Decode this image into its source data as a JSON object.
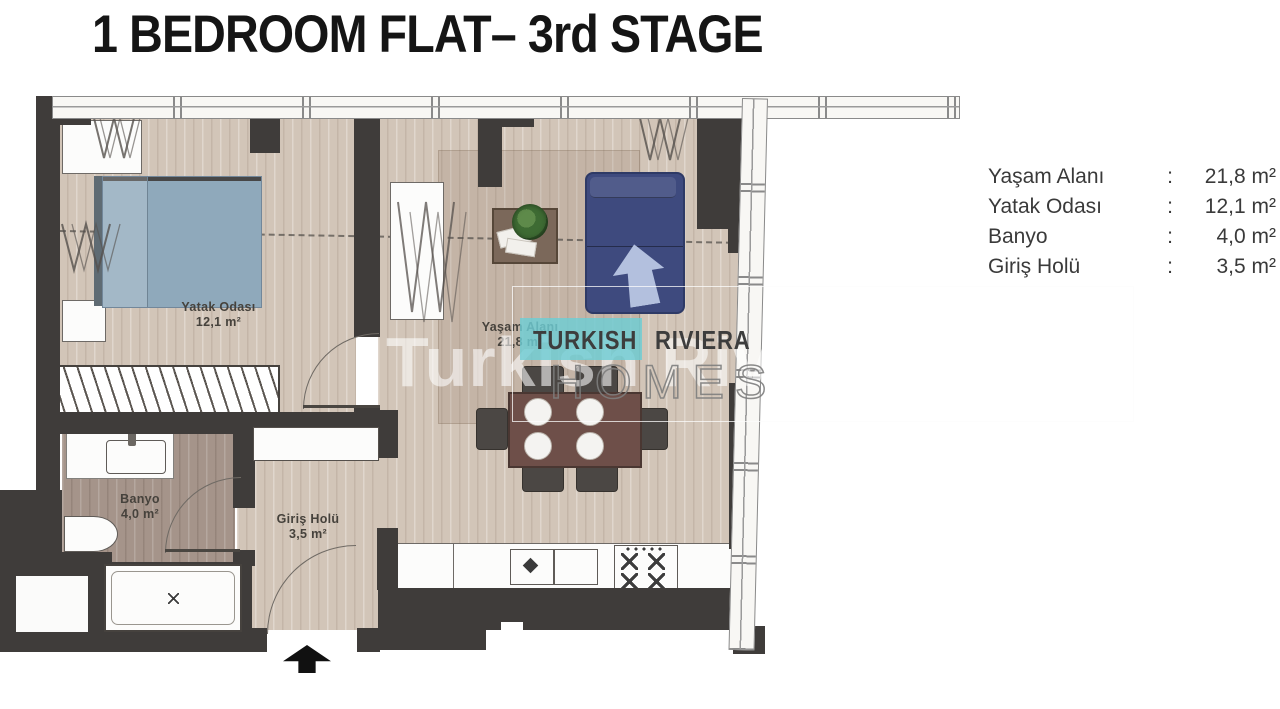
{
  "title": "1 BEDROOM FLAT– 3rd STAGE",
  "legend": {
    "rows": [
      {
        "label": "Yaşam Alanı",
        "separator": ":",
        "value": "21,8 m²"
      },
      {
        "label": "Yatak Odası",
        "separator": ":",
        "value": "12,1 m²"
      },
      {
        "label": "Banyo",
        "separator": ":",
        "value": "4,0 m²"
      },
      {
        "label": "Giriş Holü",
        "separator": ":",
        "value": "3,5 m²"
      }
    ]
  },
  "plan": {
    "rooms": {
      "bedroom": {
        "name": "Yatak Odası",
        "area": "12,1 m²"
      },
      "living": {
        "name": "Yaşam Alanı",
        "area": "21,8 m²"
      },
      "bathroom": {
        "name": "Banyo",
        "area": "4,0 m²"
      },
      "hall": {
        "name": "Giriş Holü",
        "area": "3,5 m²"
      }
    },
    "colors": {
      "wall": "#3f3c3a",
      "floor": "#d2c5b8",
      "bathroom_floor": "#a5948a",
      "bed": "#8fa9bb",
      "sofa": "#3e4a7e",
      "table": "#6e4f49",
      "accent_teal": "#7ed0d6"
    }
  },
  "watermark": {
    "brand_left": "TURKISH",
    "brand_right": "RIVIERA",
    "brand_bottom": "HOMES",
    "big_text": "Turkish Riviera H"
  }
}
